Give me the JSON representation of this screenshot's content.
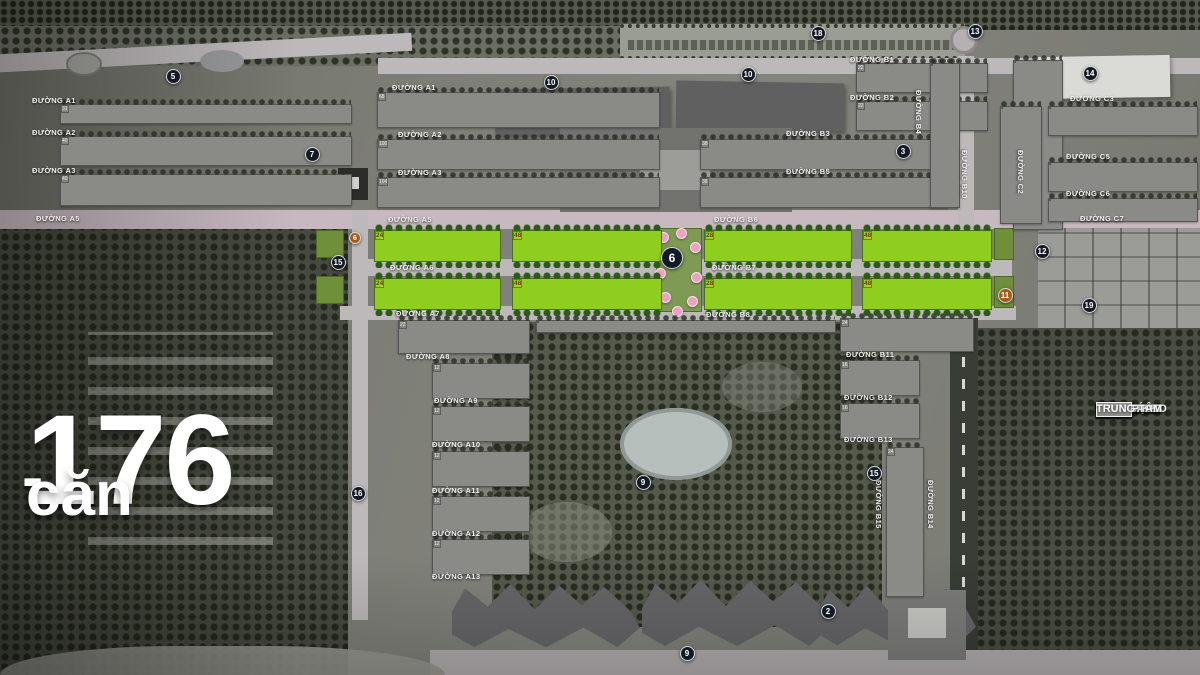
{
  "overlay": {
    "headline_number": "176",
    "headline_dash": "-",
    "headline_unit": "căn"
  },
  "legend": {
    "items": [
      {
        "label": "BIỆT THỰ SO",
        "color": "#8d8d8b"
      },
      {
        "label": "TOWN HOU",
        "color": "#8d8d8b"
      },
      {
        "label": "BIỆT THỰ Đ",
        "color": "#999997"
      },
      {
        "label": "BIỆT THỰ Đ",
        "color": "#8d8d8b"
      },
      {
        "label": "TÒA THÁP C",
        "color": "#90908e"
      },
      {
        "label": "THÁP CAO T",
        "color": "#90908e"
      },
      {
        "label": "THÁP CAO T",
        "color": "#8d8d8b"
      },
      {
        "label": "TỔ HỢP KH",
        "color": "#a7a7a5"
      },
      {
        "label": "TRUNG TÂM",
        "color": "#90908e"
      }
    ]
  },
  "map": {
    "streets": [
      {
        "t": "ĐƯỜNG A1",
        "x": 32,
        "y": 96
      },
      {
        "t": "ĐƯỜNG A1",
        "x": 392,
        "y": 83
      },
      {
        "t": "ĐƯỜNG A2",
        "x": 32,
        "y": 128
      },
      {
        "t": "ĐƯỜNG A2",
        "x": 398,
        "y": 130
      },
      {
        "t": "ĐƯỜNG A3",
        "x": 32,
        "y": 166
      },
      {
        "t": "ĐƯỜNG A3",
        "x": 398,
        "y": 168
      },
      {
        "t": "ĐƯỜNG A5",
        "x": 36,
        "y": 214
      },
      {
        "t": "ĐƯỜNG A5",
        "x": 388,
        "y": 215
      },
      {
        "t": "ĐƯỜNG A6",
        "x": 390,
        "y": 263
      },
      {
        "t": "ĐƯỜNG A7",
        "x": 396,
        "y": 309
      },
      {
        "t": "ĐƯỜNG A8",
        "x": 406,
        "y": 352
      },
      {
        "t": "ĐƯỜNG A9",
        "x": 434,
        "y": 396
      },
      {
        "t": "ĐƯỜNG A10",
        "x": 432,
        "y": 440
      },
      {
        "t": "ĐƯỜNG A11",
        "x": 432,
        "y": 486
      },
      {
        "t": "ĐƯỜNG A12",
        "x": 432,
        "y": 529
      },
      {
        "t": "ĐƯỜNG A13",
        "x": 432,
        "y": 572
      },
      {
        "t": "ĐƯỜNG B1",
        "x": 850,
        "y": 55
      },
      {
        "t": "ĐƯỜNG B2",
        "x": 850,
        "y": 93
      },
      {
        "t": "ĐƯỜNG B3",
        "x": 786,
        "y": 129
      },
      {
        "t": "ĐƯỜNG B5",
        "x": 786,
        "y": 167
      },
      {
        "t": "ĐƯỜNG B6",
        "x": 714,
        "y": 215
      },
      {
        "t": "ĐƯỜNG B7",
        "x": 712,
        "y": 263
      },
      {
        "t": "ĐƯỜNG B8",
        "x": 706,
        "y": 310
      },
      {
        "t": "ĐƯỜNG B11",
        "x": 846,
        "y": 350
      },
      {
        "t": "ĐƯỜNG B12",
        "x": 844,
        "y": 393
      },
      {
        "t": "ĐƯỜNG B13",
        "x": 844,
        "y": 435
      },
      {
        "t": "ĐƯỜNG B4",
        "x": 914,
        "y": 90,
        "rot": 1
      },
      {
        "t": "ĐƯỜNG B10",
        "x": 960,
        "y": 150,
        "rot": 1
      },
      {
        "t": "ĐƯỜNG B15",
        "x": 874,
        "y": 480,
        "rot": 1
      },
      {
        "t": "ĐƯỜNG B14",
        "x": 926,
        "y": 480,
        "rot": 1
      },
      {
        "t": "ĐƯỜNG C2",
        "x": 1016,
        "y": 150,
        "rot": 1
      },
      {
        "t": "ĐƯỜNG C3",
        "x": 1070,
        "y": 94
      },
      {
        "t": "ĐƯỜNG C5",
        "x": 1066,
        "y": 152
      },
      {
        "t": "ĐƯỜNG C6",
        "x": 1066,
        "y": 189
      },
      {
        "t": "ĐƯỜNG C7",
        "x": 1080,
        "y": 214
      }
    ],
    "markers": [
      {
        "n": "5",
        "x": 173,
        "y": 76
      },
      {
        "n": "10",
        "x": 551,
        "y": 82
      },
      {
        "n": "10",
        "x": 748,
        "y": 74
      },
      {
        "n": "18",
        "x": 818,
        "y": 33
      },
      {
        "n": "13",
        "x": 975,
        "y": 31
      },
      {
        "n": "14",
        "x": 1090,
        "y": 73
      },
      {
        "n": "7",
        "x": 312,
        "y": 154
      },
      {
        "n": "3",
        "x": 903,
        "y": 151
      },
      {
        "n": "6",
        "x": 355,
        "y": 238,
        "c": "orange",
        "s": 12
      },
      {
        "n": "15",
        "x": 338,
        "y": 262
      },
      {
        "n": "6",
        "x": 672,
        "y": 258,
        "s": 22
      },
      {
        "n": "12",
        "x": 1042,
        "y": 251
      },
      {
        "n": "11",
        "x": 1005,
        "y": 295,
        "c": "orange"
      },
      {
        "n": "19",
        "x": 1089,
        "y": 305
      },
      {
        "n": "16",
        "x": 358,
        "y": 493
      },
      {
        "n": "9",
        "x": 643,
        "y": 482
      },
      {
        "n": "15",
        "x": 874,
        "y": 473
      },
      {
        "n": "2",
        "x": 828,
        "y": 611
      },
      {
        "n": "9",
        "x": 687,
        "y": 653
      }
    ],
    "green_rows": [
      {
        "y": 230,
        "blocks": [
          {
            "x": 374,
            "w": 127,
            "top": "1 3 5 7 9 11 15 17 19 21",
            "bottom": "2 6 8 10 12 16 18 20 22 24"
          },
          {
            "x": 512,
            "w": 150,
            "top": "23 25 27 29 31 33 35 37 39 41 43 45",
            "bottom": "26 28 30 32 34 36 38 40 42 44 46 48"
          },
          {
            "x": 704,
            "w": 148,
            "top": "1 3 5 7 9 11 15 17 19 21 23 25",
            "bottom": "2 6 8 10 12 16 18 20 22 24 26 28"
          },
          {
            "x": 862,
            "w": 130,
            "top": "27 29 31 33 35 37 39 41 43 45",
            "bottom": "30 32 34 36 38 40 42 44 46 48"
          }
        ]
      },
      {
        "y": 278,
        "blocks": [
          {
            "x": 374,
            "w": 127,
            "top": "1 3 5 7 9 11 15 17 19 21",
            "bottom": "2 6 8 10 12 16 18 20 22 24"
          },
          {
            "x": 512,
            "w": 150,
            "top": "23 25 27 29 31 33 35 37 39 41 43 45",
            "bottom": "26 28 30 32 34 36 38 40 42 44 46 48"
          },
          {
            "x": 704,
            "w": 148,
            "top": "1 3 5 7 9 11 15 17 19 21 23 25",
            "bottom": "2 6 8 10 12 16 18 20 22 24 26 28"
          },
          {
            "x": 862,
            "w": 130,
            "top": "27 29 31 33 35 37 39 41 43 45",
            "bottom": "30 32 34 36 38 40 42 44 46 48"
          }
        ]
      }
    ],
    "gray_blocks": [
      {
        "x": 60,
        "y": 104,
        "w": 292,
        "h": 20,
        "rows": [
          "1 3 5 7 9 11 13 15 17 19 21 23 25 27 29 31"
        ]
      },
      {
        "x": 60,
        "y": 136,
        "w": 292,
        "h": 30,
        "rows": [
          "1 3 5 7 9 11 13 15 17 19 21 23 25 27 29 31 33 35 37",
          "2 6 8 10 12 14 16 18 20 22 24 26 28 30 32 34 36 38 40"
        ]
      },
      {
        "x": 60,
        "y": 174,
        "w": 292,
        "h": 32,
        "rows": [
          "1 3 5 7 9 11 13 15 17 19 21 23 25 27 29 31 33 35 37",
          "2 6 8 10 12 14 16 18 20 22 24 26 28 30 32 34 36 38 40"
        ]
      },
      {
        "x": 377,
        "y": 92,
        "w": 283,
        "h": 36,
        "rows": [
          "73 75 77 79 81 83 85 87 89 91 93 95 97 99",
          "42 44 46 48 50 52 54 56 58 60 62 64 66 68"
        ]
      },
      {
        "x": 377,
        "y": 139,
        "w": 283,
        "h": 31,
        "rows": [
          "71 73 75 77 79 81 83 85 87 89 91 93 95 97 99 101",
          "70 72 74 76 78 80 82 84 86 88 90 92 94 96 98 100"
        ]
      },
      {
        "x": 377,
        "y": 177,
        "w": 283,
        "h": 31,
        "rows": [
          "79 81 83 85 87 89 91 93 95 97 99 101 103",
          "78 80 82 84 86 88 90 92 94 96 98 100 102 104"
        ]
      },
      {
        "x": 700,
        "y": 139,
        "w": 248,
        "h": 31,
        "rows": [
          "1 3 5 7 9 11 13 17 19 21 23 25 27 29 31 33 35",
          "2 6 8 10 12 16 18 20 22 24 26 28 30 32 34 36 38"
        ]
      },
      {
        "x": 700,
        "y": 177,
        "w": 248,
        "h": 31,
        "rows": [
          "1 3 5 7 9 11 15 17 19 21 23 25 27 29 31 33 35",
          "2 6 8 10 12 16 18 20 22 24 26 28 30 32 34 36 38"
        ]
      },
      {
        "x": 856,
        "y": 63,
        "w": 132,
        "h": 30,
        "rows": [
          "1 3 5 7 9 11 15 17 19",
          "2 6 8 10 12 16 18 20 22"
        ]
      },
      {
        "x": 856,
        "y": 101,
        "w": 132,
        "h": 30,
        "rows": [
          "1 3 5 7 9 11 15 17 19",
          "2 6 8 10 12 16 18 20 22"
        ]
      },
      {
        "x": 1013,
        "y": 60,
        "w": 50,
        "h": 170,
        "grid": [
          2,
          10
        ]
      },
      {
        "x": 930,
        "y": 63,
        "w": 30,
        "h": 145,
        "grid": [
          2,
          8
        ]
      },
      {
        "x": 1048,
        "y": 106,
        "w": 150,
        "h": 30,
        "grid": [
          12,
          2
        ]
      },
      {
        "x": 1048,
        "y": 162,
        "w": 150,
        "h": 30,
        "grid": [
          12,
          2
        ]
      },
      {
        "x": 1048,
        "y": 198,
        "w": 150,
        "h": 24,
        "grid": [
          12,
          2
        ]
      },
      {
        "x": 1000,
        "y": 106,
        "w": 42,
        "h": 118,
        "grid": [
          2,
          7
        ]
      },
      {
        "x": 398,
        "y": 320,
        "w": 132,
        "h": 34,
        "rows": [
          "1 3 5 7 9 11 15 17 19",
          "2 6 8 10 12 16 18 20 22"
        ]
      },
      {
        "x": 432,
        "y": 363,
        "w": 98,
        "h": 36,
        "rows": [
          "1 3 5 7 9",
          "2 6 8 10 12"
        ]
      },
      {
        "x": 432,
        "y": 406,
        "w": 98,
        "h": 36,
        "rows": [
          "1 3 5 7 9",
          "2 6 8 10 12"
        ]
      },
      {
        "x": 432,
        "y": 451,
        "w": 98,
        "h": 36,
        "rows": [
          "1 3 5 7 9",
          "2 6 8 10 12"
        ]
      },
      {
        "x": 432,
        "y": 496,
        "w": 98,
        "h": 36,
        "rows": [
          "1 3 5 7 9",
          "2 6 8 10 12"
        ]
      },
      {
        "x": 432,
        "y": 539,
        "w": 98,
        "h": 36,
        "rows": [
          "1 3 5 7 9",
          "2 6 8 10 12"
        ]
      },
      {
        "x": 840,
        "y": 318,
        "w": 134,
        "h": 34,
        "rows": [
          "1 3 5 7 9 11 15 17 19 21",
          "2 6 8 10 12 16 18 20 22 24"
        ]
      },
      {
        "x": 840,
        "y": 360,
        "w": 80,
        "h": 36,
        "rows": [
          "1 3 5 7 9 11",
          "2 6 8 10 12 16"
        ]
      },
      {
        "x": 840,
        "y": 403,
        "w": 80,
        "h": 36,
        "rows": [
          "1 3 5 7 9 11",
          "2 6 8 10 12 16"
        ]
      },
      {
        "x": 886,
        "y": 447,
        "w": 38,
        "h": 150,
        "rows": [
          "1 2",
          "3 6",
          "5 8",
          "7 10",
          "9 12",
          "11 16",
          "13 18",
          "17 20",
          "19 22",
          "21 24"
        ]
      },
      {
        "x": 536,
        "y": 320,
        "w": 300,
        "h": 13,
        "grid": [
          24,
          1
        ]
      }
    ],
    "colors": {
      "lot_green": "#93d021",
      "lot_green_border": "#4f7d17",
      "lot_number": "#7a3a0c",
      "marker_dark": "#141a24",
      "marker_orange": "#a85a16",
      "road_light": "#bdb8ba",
      "road_pink": "#c8b9c0"
    }
  }
}
